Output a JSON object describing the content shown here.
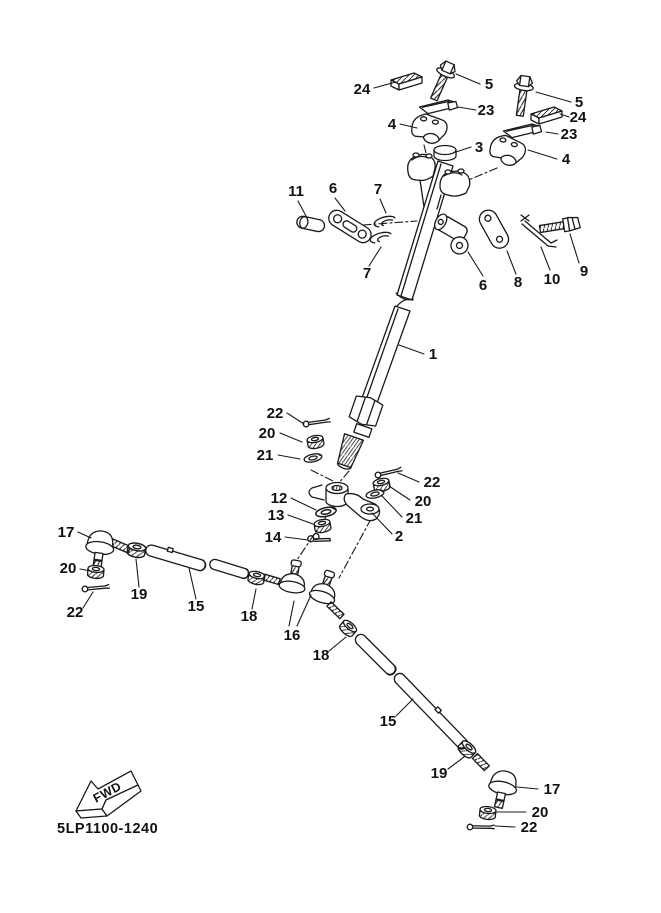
{
  "diagram": {
    "drawing_number": "5LP1100-1240",
    "fwd_label": "FWD",
    "colors": {
      "ink": "#1a1a1a",
      "background": "#ffffff"
    },
    "callouts": [
      {
        "label": "24"
      },
      {
        "label": "5"
      },
      {
        "label": "23"
      },
      {
        "label": "4"
      },
      {
        "label": "5"
      },
      {
        "label": "24"
      },
      {
        "label": "23"
      },
      {
        "label": "3"
      },
      {
        "label": "4"
      },
      {
        "label": "11"
      },
      {
        "label": "6"
      },
      {
        "label": "7"
      },
      {
        "label": "7"
      },
      {
        "label": "6"
      },
      {
        "label": "8"
      },
      {
        "label": "10"
      },
      {
        "label": "9"
      },
      {
        "label": "1"
      },
      {
        "label": "22"
      },
      {
        "label": "20"
      },
      {
        "label": "21"
      },
      {
        "label": "22"
      },
      {
        "label": "20"
      },
      {
        "label": "21"
      },
      {
        "label": "2"
      },
      {
        "label": "12"
      },
      {
        "label": "13"
      },
      {
        "label": "14"
      },
      {
        "label": "17"
      },
      {
        "label": "20"
      },
      {
        "label": "22"
      },
      {
        "label": "19"
      },
      {
        "label": "15"
      },
      {
        "label": "18"
      },
      {
        "label": "16"
      },
      {
        "label": "18"
      },
      {
        "label": "15"
      },
      {
        "label": "19"
      },
      {
        "label": "17"
      },
      {
        "label": "20"
      },
      {
        "label": "22"
      }
    ]
  }
}
